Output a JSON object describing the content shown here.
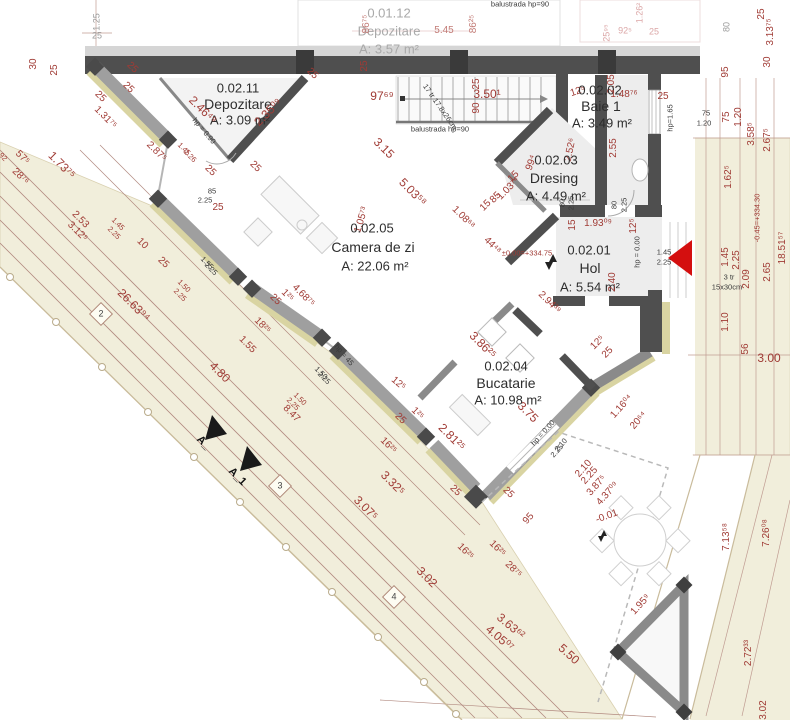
{
  "meta": {
    "title": "Floor plan - level 0.02",
    "plan_type": "architectural floor plan"
  },
  "palette": {
    "dimension_red": "#a03b35",
    "ghost_pink": "#dba6a6",
    "ground_beige": "#f1eedb",
    "wall_dark": "#4f4f4f",
    "wall_mid": "#9f9f9f",
    "insulation_khaki": "#d9d4a2",
    "entrance_arrow_red": "#d40f0f",
    "floor_gray": "#ededed"
  },
  "rooms": [
    {
      "id": "0.01.12",
      "name": "Depozitare",
      "area": "A: 3.57 m²"
    },
    {
      "id": "0.02.11",
      "name": "Depozitare",
      "area": "A: 3.09 m²"
    },
    {
      "id": "0.02.05",
      "name": "Camera de zi",
      "area": "A: 22.06 m²"
    },
    {
      "id": "0.02.03",
      "name": "Dresing",
      "area": "A: 4.49 m²"
    },
    {
      "id": "0.02.02",
      "name": "Baie 1",
      "area": "A: 3.49 m²"
    },
    {
      "id": "0.02.01",
      "name": "Hol",
      "area": "A: 5.54 m²"
    },
    {
      "id": "0.02.04",
      "name": "Bucatarie",
      "area": "A: 10.98 m²"
    }
  ],
  "levels": [
    "±0.00=+334.75",
    "-0.45=+334.30",
    "-0.01"
  ],
  "notes": [
    "balustrada hp=90",
    "17 tr 17.8x26cm",
    "3 tr 15x30cm",
    "hp = 0.90",
    "hp = 0.00",
    "hp = 45",
    "hp=1.65"
  ],
  "section_markers": [
    "A_",
    "A_1"
  ],
  "axis_markers": [
    "2",
    "3",
    "4"
  ],
  "labels": [
    {
      "t": "0.01.12",
      "x": 389,
      "y": 13,
      "r": 0,
      "c": "ghost-id"
    },
    {
      "t": "Depozitare",
      "x": 389,
      "y": 31,
      "r": 0,
      "c": "ghost-name"
    },
    {
      "t": "A: 3.57 m²",
      "x": 389,
      "y": 49,
      "r": 0,
      "c": "ghost-name"
    },
    {
      "t": "5.45",
      "x": 444,
      "y": 31,
      "r": 0,
      "c": "dim-f"
    },
    {
      "t": "86⁷⁵",
      "x": 367,
      "y": 24,
      "r": -90,
      "c": "dim-f"
    },
    {
      "t": "86²⁵",
      "x": 474,
      "y": 24,
      "r": -90,
      "c": "dim-f"
    },
    {
      "t": "balustrada hp=90",
      "x": 520,
      "y": 4,
      "r": 0,
      "c": "blk-sm"
    },
    {
      "t": "92⁵",
      "x": 625,
      "y": 31,
      "r": 0,
      "c": "pink"
    },
    {
      "t": "25",
      "x": 654,
      "y": 32,
      "r": 0,
      "c": "pink"
    },
    {
      "t": "1.26²",
      "x": 640,
      "y": 13,
      "r": -90,
      "c": "pink"
    },
    {
      "t": "25⁹⁵",
      "x": 607,
      "y": 33,
      "r": -90,
      "c": "pink"
    },
    {
      "t": "1.25",
      "x": 97,
      "y": 22,
      "r": -90,
      "c": "gray"
    },
    {
      "t": "25",
      "x": 97,
      "y": 36,
      "r": 0,
      "c": "gray"
    },
    {
      "t": "80",
      "x": 727,
      "y": 27,
      "r": -90,
      "c": "gray"
    },
    {
      "t": "25",
      "x": 762,
      "y": 14,
      "r": -90,
      "c": "dim"
    },
    {
      "t": "3.13⁷⁵",
      "x": 771,
      "y": 32,
      "r": -90,
      "c": "dim"
    },
    {
      "t": "30",
      "x": 34,
      "y": 64,
      "r": -90,
      "c": "dim"
    },
    {
      "t": "25",
      "x": 55,
      "y": 70,
      "r": -90,
      "c": "dim"
    },
    {
      "t": "25",
      "x": 365,
      "y": 66,
      "r": -90,
      "c": "dim"
    },
    {
      "t": "25",
      "x": 132,
      "y": 68,
      "r": 45,
      "c": "dim"
    },
    {
      "t": "25",
      "x": 128,
      "y": 88,
      "r": 45,
      "c": "dim"
    },
    {
      "t": "25",
      "x": 100,
      "y": 97,
      "r": 45,
      "c": "dim"
    },
    {
      "t": "25",
      "x": 210,
      "y": 171,
      "r": 45,
      "c": "dim"
    },
    {
      "t": "25",
      "x": 255,
      "y": 167,
      "r": 45,
      "c": "dim"
    },
    {
      "t": "25",
      "x": 312,
      "y": 74,
      "r": 45,
      "c": "dim"
    },
    {
      "t": "0.02.11",
      "x": 238,
      "y": 88,
      "r": 0,
      "c": "room-id"
    },
    {
      "t": "Depozitare",
      "x": 238,
      "y": 104,
      "r": 0,
      "c": "room-name"
    },
    {
      "t": "A: 3.09 m²",
      "x": 240,
      "y": 120,
      "r": 0,
      "c": "room-area"
    },
    {
      "t": "2.46⁴⁹",
      "x": 203,
      "y": 110,
      "r": 45,
      "c": "dim-lg"
    },
    {
      "t": "2.35⁰⁹",
      "x": 268,
      "y": 112,
      "r": -45,
      "c": "dim-lg"
    },
    {
      "t": "1.31⁷⁵",
      "x": 105,
      "y": 118,
      "r": 45,
      "c": "dim"
    },
    {
      "t": "2.87⁵",
      "x": 156,
      "y": 152,
      "r": 45,
      "c": "dim"
    },
    {
      "t": "1.45",
      "x": 184,
      "y": 149,
      "r": 45,
      "c": "dim-sm"
    },
    {
      "t": "2.26",
      "x": 190,
      "y": 156,
      "r": 45,
      "c": "dim-sm"
    },
    {
      "t": "hp = 0.90",
      "x": 204,
      "y": 131,
      "r": 50,
      "c": "blk-sm"
    },
    {
      "t": "85",
      "x": 212,
      "y": 191,
      "r": 0,
      "c": "blk-sm"
    },
    {
      "t": "2.25",
      "x": 205,
      "y": 200,
      "r": 0,
      "c": "blk-sm"
    },
    {
      "t": "25",
      "x": 218,
      "y": 208,
      "r": 0,
      "c": "dim"
    },
    {
      "t": "97⁶⁹",
      "x": 382,
      "y": 96,
      "r": 0,
      "c": "dim-lg"
    },
    {
      "t": "17 tr 17.8x26cm",
      "x": 440,
      "y": 107,
      "r": 55,
      "c": "blk-sm"
    },
    {
      "t": "3.50¹",
      "x": 487,
      "y": 94,
      "r": 0,
      "c": "dim-lg"
    },
    {
      "t": "25",
      "x": 477,
      "y": 84,
      "r": -90,
      "c": "dim"
    },
    {
      "t": "90",
      "x": 477,
      "y": 108,
      "r": -90,
      "c": "dim"
    },
    {
      "t": "balustrada hp=90",
      "x": 440,
      "y": 129,
      "r": 0,
      "c": "blk-sm"
    },
    {
      "t": "3.15",
      "x": 384,
      "y": 148,
      "r": 45,
      "c": "dim-lg"
    },
    {
      "t": "5.03⁵⁸",
      "x": 413,
      "y": 192,
      "r": 45,
      "c": "dim-lg"
    },
    {
      "t": "1.05⁷³",
      "x": 362,
      "y": 220,
      "r": -73,
      "c": "dim"
    },
    {
      "t": "0.02.05",
      "x": 372,
      "y": 228,
      "r": 0,
      "c": "room-id"
    },
    {
      "t": "Camera de zi",
      "x": 373,
      "y": 247,
      "r": 0,
      "c": "room-name"
    },
    {
      "t": "A: 22.06 m²",
      "x": 375,
      "y": 266,
      "r": 0,
      "c": "room-area"
    },
    {
      "t": "1.08⁶⁸",
      "x": 463,
      "y": 218,
      "r": 45,
      "c": "dim"
    },
    {
      "t": "15",
      "x": 486,
      "y": 206,
      "r": -45,
      "c": "dim"
    },
    {
      "t": "85",
      "x": 496,
      "y": 198,
      "r": -45,
      "c": "dim"
    },
    {
      "t": "1.03⁷⁴",
      "x": 509,
      "y": 189,
      "r": -45,
      "c": "dim"
    },
    {
      "t": "44⁴⁸",
      "x": 492,
      "y": 246,
      "r": 45,
      "c": "dim"
    },
    {
      "t": "99⁴",
      "x": 532,
      "y": 163,
      "r": -70,
      "c": "dim"
    },
    {
      "t": "2.52⁶",
      "x": 571,
      "y": 150,
      "r": -78,
      "c": "dim"
    },
    {
      "t": "15",
      "x": 514,
      "y": 177,
      "r": -45,
      "c": "dim"
    },
    {
      "t": "0.02.03",
      "x": 556,
      "y": 160,
      "r": 0,
      "c": "room-id"
    },
    {
      "t": "Dresing",
      "x": 554,
      "y": 178,
      "r": 0,
      "c": "room-name"
    },
    {
      "t": "A: 4.49 m²",
      "x": 556,
      "y": 196,
      "r": 0,
      "c": "room-area"
    },
    {
      "t": "12⁵",
      "x": 578,
      "y": 92,
      "r": -18,
      "c": "dim"
    },
    {
      "t": "2.05",
      "x": 612,
      "y": 84,
      "r": -90,
      "c": "dim"
    },
    {
      "t": "0.02.02",
      "x": 600,
      "y": 90,
      "r": 0,
      "c": "room-id"
    },
    {
      "t": "Baie 1",
      "x": 601,
      "y": 106,
      "r": 0,
      "c": "room-name"
    },
    {
      "t": "A: 3.49 m²",
      "x": 602,
      "y": 123,
      "r": 0,
      "c": "room-area"
    },
    {
      "t": "1.48⁷⁶",
      "x": 624,
      "y": 95,
      "r": 0,
      "c": "dim"
    },
    {
      "t": "25",
      "x": 663,
      "y": 97,
      "r": 0,
      "c": "dim"
    },
    {
      "t": "2.55",
      "x": 614,
      "y": 148,
      "r": -90,
      "c": "dim"
    },
    {
      "t": "hp=1.65",
      "x": 670,
      "y": 118,
      "r": -90,
      "c": "blk-sm"
    },
    {
      "t": "80",
      "x": 562,
      "y": 203,
      "r": -90,
      "c": "blk-sm"
    },
    {
      "t": "2.25",
      "x": 571,
      "y": 203,
      "r": -90,
      "c": "blk-sm"
    },
    {
      "t": "80",
      "x": 614,
      "y": 205,
      "r": -90,
      "c": "blk-sm"
    },
    {
      "t": "2.25",
      "x": 624,
      "y": 205,
      "r": -90,
      "c": "blk-sm"
    },
    {
      "t": "15",
      "x": 573,
      "y": 225,
      "r": -90,
      "c": "dim"
    },
    {
      "t": "1.93⁰⁹",
      "x": 598,
      "y": 224,
      "r": 0,
      "c": "dim"
    },
    {
      "t": "12⁵",
      "x": 634,
      "y": 226,
      "r": -90,
      "c": "dim"
    },
    {
      "t": "±0.00=+334.75",
      "x": 527,
      "y": 253,
      "r": 0,
      "c": "dim-sm"
    },
    {
      "t": "0.02.01",
      "x": 589,
      "y": 250,
      "r": 0,
      "c": "room-id"
    },
    {
      "t": "Hol",
      "x": 590,
      "y": 268,
      "r": 0,
      "c": "room-name"
    },
    {
      "t": "A: 5.54 m²",
      "x": 590,
      "y": 287,
      "r": 0,
      "c": "room-area"
    },
    {
      "t": "2.40",
      "x": 613,
      "y": 282,
      "r": -90,
      "c": "dim"
    },
    {
      "t": "2.94³⁹",
      "x": 549,
      "y": 303,
      "r": 45,
      "c": "dim"
    },
    {
      "t": "hp = 0.00",
      "x": 637,
      "y": 252,
      "r": -90,
      "c": "blk-sm"
    },
    {
      "t": "1.45",
      "x": 664,
      "y": 252,
      "r": 0,
      "c": "blk-sm"
    },
    {
      "t": "2.25",
      "x": 664,
      "y": 262,
      "r": 0,
      "c": "blk-sm"
    },
    {
      "t": "1.45",
      "x": 726,
      "y": 257,
      "r": -90,
      "c": "dim"
    },
    {
      "t": "2.25",
      "x": 737,
      "y": 260,
      "r": -90,
      "c": "dim"
    },
    {
      "t": "3 tr",
      "x": 729,
      "y": 277,
      "r": 0,
      "c": "blk-sm"
    },
    {
      "t": "15x30cm",
      "x": 727,
      "y": 287,
      "r": 0,
      "c": "blk-sm"
    },
    {
      "t": "2.09",
      "x": 747,
      "y": 279,
      "r": -90,
      "c": "dim"
    },
    {
      "t": "2.65",
      "x": 768,
      "y": 272,
      "r": -90,
      "c": "dim"
    },
    {
      "t": "-0.45=+334.30",
      "x": 757,
      "y": 218,
      "r": -90,
      "c": "dim-sm"
    },
    {
      "t": "18.51⁵⁷",
      "x": 783,
      "y": 248,
      "r": -90,
      "c": "dim"
    },
    {
      "t": "95",
      "x": 726,
      "y": 72,
      "r": -90,
      "c": "dim"
    },
    {
      "t": "30",
      "x": 768,
      "y": 62,
      "r": -90,
      "c": "dim"
    },
    {
      "t": "75",
      "x": 706,
      "y": 113,
      "r": 0,
      "c": "blk-sm"
    },
    {
      "t": "1.20",
      "x": 704,
      "y": 123,
      "r": 0,
      "c": "blk-sm"
    },
    {
      "t": "75",
      "x": 727,
      "y": 117,
      "r": -90,
      "c": "dim"
    },
    {
      "t": "1.20",
      "x": 739,
      "y": 117,
      "r": -90,
      "c": "dim"
    },
    {
      "t": "3.58⁵",
      "x": 752,
      "y": 134,
      "r": -90,
      "c": "dim"
    },
    {
      "t": "2.67⁵",
      "x": 768,
      "y": 140,
      "r": -90,
      "c": "dim"
    },
    {
      "t": "1.62⁵",
      "x": 729,
      "y": 177,
      "r": -90,
      "c": "dim"
    },
    {
      "t": "1.10",
      "x": 726,
      "y": 322,
      "r": -90,
      "c": "dim"
    },
    {
      "t": "56",
      "x": 746,
      "y": 349,
      "r": -90,
      "c": "dim"
    },
    {
      "t": "3.00",
      "x": 769,
      "y": 358,
      "r": 0,
      "c": "dim-lg"
    },
    {
      "t": "7.13⁵⁸",
      "x": 727,
      "y": 537,
      "r": -90,
      "c": "dim"
    },
    {
      "t": "7.26⁰⁸",
      "x": 767,
      "y": 533,
      "r": -90,
      "c": "dim"
    },
    {
      "t": "2.72³³",
      "x": 749,
      "y": 653,
      "r": -90,
      "c": "dim"
    },
    {
      "t": "3.02",
      "x": 764,
      "y": 710,
      "r": -90,
      "c": "dim"
    },
    {
      "t": "3.86²⁵",
      "x": 483,
      "y": 345,
      "r": 45,
      "c": "dim-lg"
    },
    {
      "t": "12⁵",
      "x": 398,
      "y": 384,
      "r": 40,
      "c": "dim"
    },
    {
      "t": "25",
      "x": 400,
      "y": 419,
      "r": 45,
      "c": "dim"
    },
    {
      "t": "1²⁵",
      "x": 417,
      "y": 414,
      "r": 45,
      "c": "dim"
    },
    {
      "t": "2.81²⁵",
      "x": 452,
      "y": 437,
      "r": 45,
      "c": "dim-lg"
    },
    {
      "t": "0.02.04",
      "x": 506,
      "y": 366,
      "r": 0,
      "c": "room-id"
    },
    {
      "t": "Bucatarie",
      "x": 506,
      "y": 383,
      "r": 0,
      "c": "room-name"
    },
    {
      "t": "A: 10.98 m²",
      "x": 508,
      "y": 400,
      "r": 0,
      "c": "room-area"
    },
    {
      "t": "3.75",
      "x": 528,
      "y": 412,
      "r": 45,
      "c": "dim-lg"
    },
    {
      "t": "hp = 0.00",
      "x": 543,
      "y": 433,
      "r": -48,
      "c": "blk-sm"
    },
    {
      "t": "2.10",
      "x": 561,
      "y": 445,
      "r": -48,
      "c": "blk-sm"
    },
    {
      "t": "2.25",
      "x": 557,
      "y": 451,
      "r": -48,
      "c": "blk-sm"
    },
    {
      "t": "2.10",
      "x": 584,
      "y": 469,
      "r": -48,
      "c": "dim"
    },
    {
      "t": "2.25",
      "x": 590,
      "y": 476,
      "r": -48,
      "c": "dim"
    },
    {
      "t": "3.87⁵",
      "x": 597,
      "y": 486,
      "r": -48,
      "c": "dim"
    },
    {
      "t": "4.37⁰⁹",
      "x": 608,
      "y": 494,
      "r": -48,
      "c": "dim"
    },
    {
      "t": "-0.01",
      "x": 607,
      "y": 517,
      "r": -20,
      "c": "dim"
    },
    {
      "t": "95",
      "x": 529,
      "y": 519,
      "r": -48,
      "c": "dim"
    },
    {
      "t": "12⁵",
      "x": 598,
      "y": 343,
      "r": -45,
      "c": "dim"
    },
    {
      "t": "25",
      "x": 608,
      "y": 353,
      "r": -45,
      "c": "dim"
    },
    {
      "t": "1.16⁰⁴",
      "x": 622,
      "y": 407,
      "r": -48,
      "c": "dim"
    },
    {
      "t": "20⁶⁴",
      "x": 639,
      "y": 421,
      "r": -48,
      "c": "dim"
    },
    {
      "t": "1.95⁹",
      "x": 641,
      "y": 605,
      "r": -48,
      "c": "dim"
    },
    {
      "t": "25",
      "x": 455,
      "y": 491,
      "r": 45,
      "c": "dim"
    },
    {
      "t": "25",
      "x": 508,
      "y": 493,
      "r": 45,
      "c": "dim"
    },
    {
      "t": "92",
      "x": 3,
      "y": 157,
      "r": 45,
      "c": "dim-sm"
    },
    {
      "t": "57⁵",
      "x": 22,
      "y": 158,
      "r": 45,
      "c": "dim"
    },
    {
      "t": "28⁷⁶",
      "x": 20,
      "y": 177,
      "r": 45,
      "c": "dim"
    },
    {
      "t": "1.73⁷⁵",
      "x": 62,
      "y": 165,
      "r": 45,
      "c": "dim-lg"
    },
    {
      "t": "2.53",
      "x": 80,
      "y": 220,
      "r": 45,
      "c": "dim"
    },
    {
      "t": "3.12⁵",
      "x": 77,
      "y": 232,
      "r": 45,
      "c": "dim"
    },
    {
      "t": "1.45",
      "x": 118,
      "y": 224,
      "r": 45,
      "c": "dim-sm"
    },
    {
      "t": "2.25",
      "x": 114,
      "y": 233,
      "r": 45,
      "c": "dim-sm"
    },
    {
      "t": "10",
      "x": 142,
      "y": 244,
      "r": 45,
      "c": "dim"
    },
    {
      "t": "25",
      "x": 163,
      "y": 263,
      "r": 45,
      "c": "dim"
    },
    {
      "t": "1.50",
      "x": 184,
      "y": 286,
      "r": 45,
      "c": "dim-sm"
    },
    {
      "t": "2.25",
      "x": 180,
      "y": 295,
      "r": 45,
      "c": "dim-sm"
    },
    {
      "t": "26.63⁹⁴",
      "x": 134,
      "y": 305,
      "r": 45,
      "c": "dim-lg"
    },
    {
      "t": "1.55",
      "x": 207,
      "y": 263,
      "r": 45,
      "c": "blk-sm"
    },
    {
      "t": "2.25",
      "x": 211,
      "y": 269,
      "r": 45,
      "c": "blk-sm"
    },
    {
      "t": "1.55",
      "x": 247,
      "y": 345,
      "r": 45,
      "c": "dim"
    },
    {
      "t": "4.80",
      "x": 220,
      "y": 372,
      "r": 45,
      "c": "dim-lg"
    },
    {
      "t": "18²⁵",
      "x": 262,
      "y": 326,
      "r": 45,
      "c": "dim"
    },
    {
      "t": "25",
      "x": 275,
      "y": 300,
      "r": 45,
      "c": "dim"
    },
    {
      "t": "1²⁵",
      "x": 287,
      "y": 296,
      "r": 45,
      "c": "dim"
    },
    {
      "t": "4.68⁷⁵",
      "x": 303,
      "y": 296,
      "r": 45,
      "c": "dim"
    },
    {
      "t": "1.50",
      "x": 321,
      "y": 373,
      "r": 45,
      "c": "blk-sm"
    },
    {
      "t": "2.25",
      "x": 324,
      "y": 378,
      "r": 45,
      "c": "blk-sm"
    },
    {
      "t": "hp = 45",
      "x": 344,
      "y": 355,
      "r": 50,
      "c": "blk-sm"
    },
    {
      "t": "1.50",
      "x": 300,
      "y": 399,
      "r": 45,
      "c": "dim-sm"
    },
    {
      "t": "2.25",
      "x": 293,
      "y": 404,
      "r": 45,
      "c": "dim-sm"
    },
    {
      "t": "8.47",
      "x": 291,
      "y": 414,
      "r": 45,
      "c": "dim"
    },
    {
      "t": "16²⁵",
      "x": 388,
      "y": 446,
      "r": 45,
      "c": "dim"
    },
    {
      "t": "3.32⁵",
      "x": 393,
      "y": 483,
      "r": 45,
      "c": "dim-lg"
    },
    {
      "t": "3.02",
      "x": 427,
      "y": 577,
      "r": 45,
      "c": "dim-lg"
    },
    {
      "t": "16²⁵",
      "x": 465,
      "y": 552,
      "r": 45,
      "c": "dim"
    },
    {
      "t": "16²⁵",
      "x": 497,
      "y": 549,
      "r": 45,
      "c": "dim"
    },
    {
      "t": "28⁷⁵",
      "x": 513,
      "y": 570,
      "r": 45,
      "c": "dim"
    },
    {
      "t": "3.63⁶²",
      "x": 511,
      "y": 626,
      "r": 40,
      "c": "dim-lg"
    },
    {
      "t": "4.05⁰⁷",
      "x": 500,
      "y": 638,
      "r": 40,
      "c": "dim-lg"
    },
    {
      "t": "5.50",
      "x": 569,
      "y": 654,
      "r": 42,
      "c": "dim-lg"
    },
    {
      "t": "3.07⁵",
      "x": 366,
      "y": 508,
      "r": 45,
      "c": "dim-lg"
    },
    {
      "t": "A_",
      "x": 203,
      "y": 443,
      "r": 45,
      "c": "blk"
    },
    {
      "t": "A_1",
      "x": 237,
      "y": 477,
      "r": 45,
      "c": "blk"
    },
    {
      "t": "2",
      "x": 101,
      "y": 314,
      "r": 0,
      "c": "axis"
    },
    {
      "t": "3",
      "x": 280,
      "y": 486,
      "r": 0,
      "c": "axis"
    },
    {
      "t": "4",
      "x": 394,
      "y": 597,
      "r": 0,
      "c": "axis"
    }
  ]
}
